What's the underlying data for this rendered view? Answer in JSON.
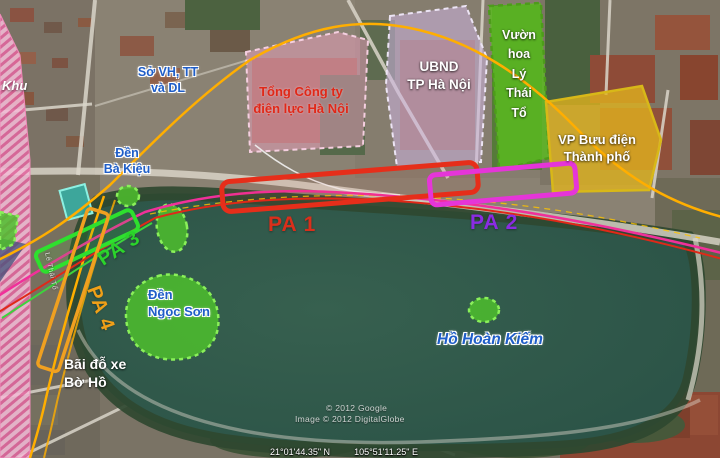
{
  "map_labels": {
    "district": "Khu",
    "so_vh_tt": {
      "line1": "Sở VH, TT",
      "line2": "và DL"
    },
    "den_ba_kieu": {
      "line1": "Đền",
      "line2": "Bà Kiệu"
    },
    "tong_cong_ty": {
      "line1": "Tổng Công ty",
      "line2": "điện lực Hà Nội"
    },
    "ubnd": {
      "line1": "UBND",
      "line2": "TP Hà Nội"
    },
    "vuon_hoa": {
      "lines": [
        "Vườn",
        "hoa",
        "Lý",
        "Thái",
        "Tổ"
      ]
    },
    "vp_buu_dien": {
      "line1": "VP Bưu điện",
      "line2": "Thành phố"
    },
    "den_ngoc_son": {
      "line1": "Đền",
      "line2": "Ngọc Sơn"
    },
    "bai_do_xe": {
      "line1": "Bãi đỗ xe",
      "line2": "Bờ Hồ"
    },
    "lake": "Hồ Hoàn Kiếm",
    "street": "Lê Thái Tổ"
  },
  "station_options": [
    {
      "label": "PA 1",
      "color": "#d92f1b"
    },
    {
      "label": "PA 2",
      "color": "#8a2ce2"
    },
    {
      "label": "PA 3",
      "color": "#2bd42b"
    },
    {
      "label": "PA 4",
      "color": "#f0a018"
    }
  ],
  "route_colors": {
    "metro_line_orange": "#ffae00",
    "line_magenta": "#f0309a",
    "line_red": "#e02818",
    "line_green": "#3cd43c"
  },
  "credits": {
    "google": "© 2012 Google",
    "digitalglobe": "Image © 2012 DigitalGlobe"
  },
  "status_bar": {
    "latitude": "21°01'44.35\" N",
    "longitude": "105°51'11.25\" E"
  }
}
